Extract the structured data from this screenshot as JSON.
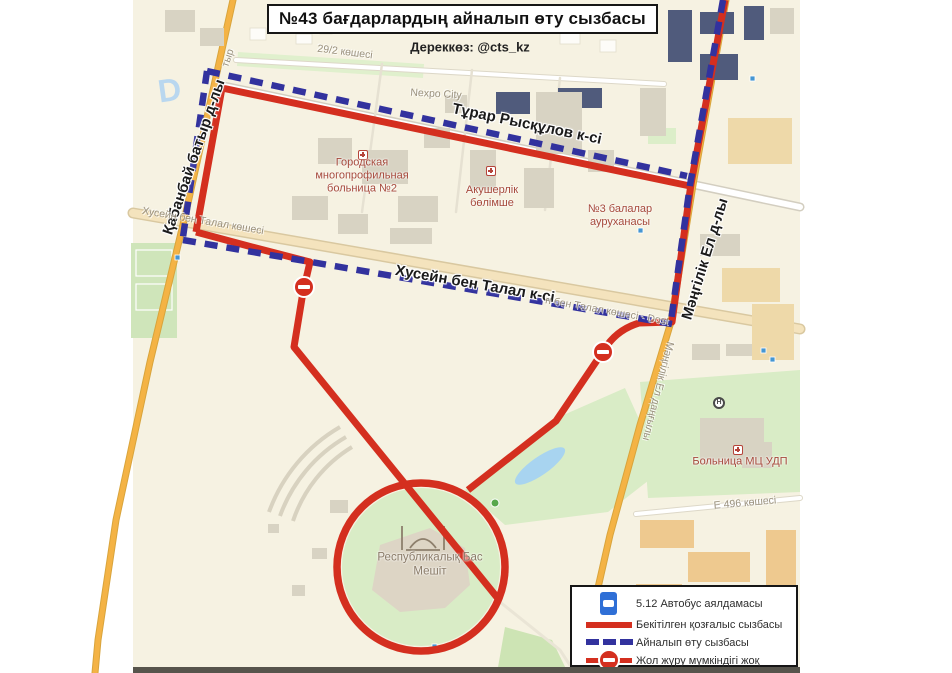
{
  "title": "№43 бағдарлардың айналып өту сызбасы",
  "source": "Дереккөз: @cts_kz",
  "legend": {
    "items": [
      {
        "icon": "bus-stop-sign-icon",
        "label": "5.12 Автобус аялдамасы"
      },
      {
        "icon": "approved-route-line",
        "label": "Бекітілген қозғалыс сызбасы"
      },
      {
        "icon": "detour-route-line",
        "label": "Айналып өту сызбасы"
      },
      {
        "icon": "road-closed-sign",
        "label": "Жол жүру мүмкіндігі жоқ"
      }
    ]
  },
  "streets": {
    "turar": "Тұрар Рысқұлов к-сі",
    "khusein_black": "Хусейн бен Талал к-сі",
    "kabanbay": "Қабанбай батыр д-лы",
    "mangilik_black": "Мәңгілік Ел д-лы",
    "khusein_gray_left": "Хусейн бен Талал көшесі",
    "khusein_gray_right": "н бен Талал көшесі - Dost",
    "mangilik_gray": "Мәңгілік Ел даңғылы",
    "kabanbay_gray_fragment": "тыр",
    "street_29_2": "29/2 көшесі",
    "e496": "Е 496 көшесі"
  },
  "places": {
    "nexpo": "Nexpo City",
    "hospital2": "Городская многопрофильная больница №2",
    "akusherlik": "Акушерлік бөлімше",
    "children_hospital": "№3 балалар ауруханасы",
    "udp_hospital": "Больница МЦ УДП",
    "mosque": "Республикалық Бас Мешіт"
  },
  "colors": {
    "route_red": "#d42f1f",
    "detour_blue": "#32329e",
    "map_bg": "#f6f2e2",
    "road_orange": "#f4b345",
    "poi_red": "#a6493b",
    "label_gray": "#9a917e",
    "park_green": "#d9ecc6"
  }
}
